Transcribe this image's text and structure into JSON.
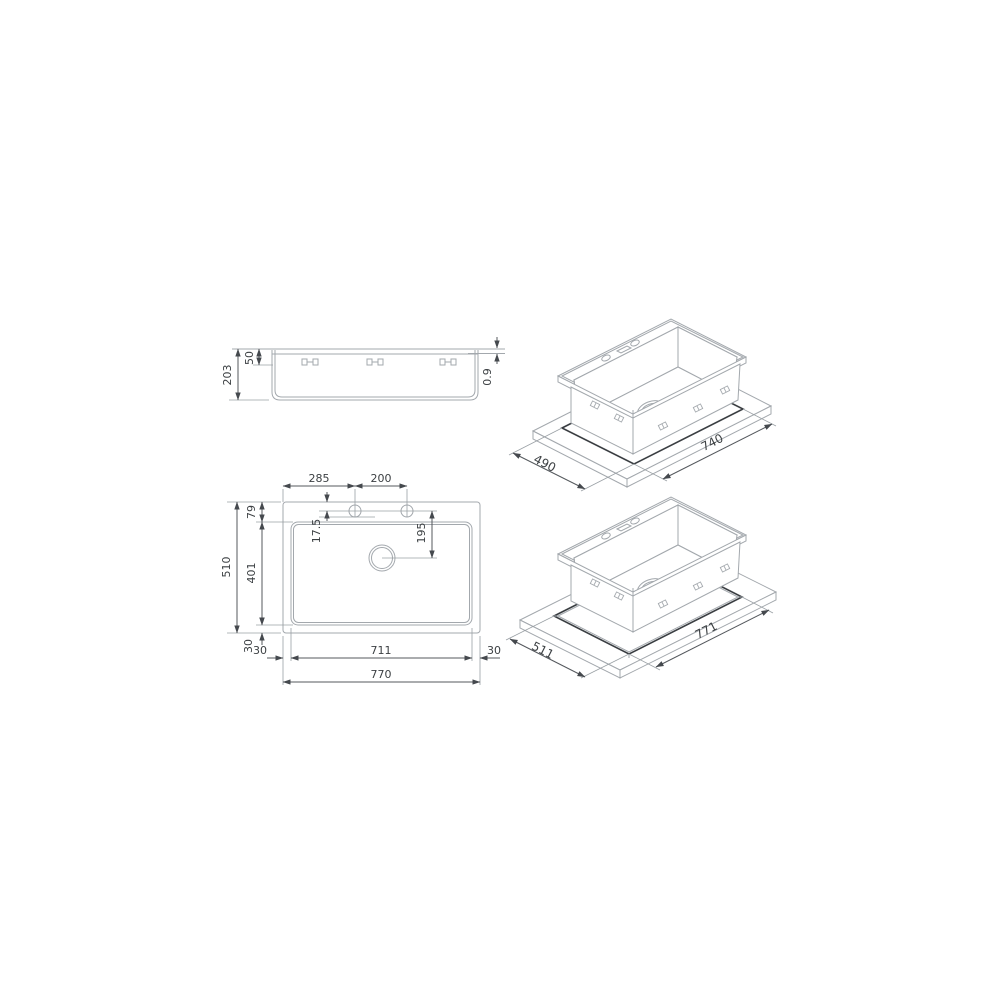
{
  "drawing_title": "Sink technical dimension drawing",
  "colors": {
    "background": "#ffffff",
    "object_line": "#a3a8ad",
    "dimension_line": "#54585d",
    "text": "#3c4043",
    "cutout_line": "#3a3e42"
  },
  "side_view": {
    "overall_height": "203",
    "rim_to_clip": "50",
    "rim_thickness": "0.9"
  },
  "plan_view": {
    "hole_offset_left": "285",
    "hole_spacing": "200",
    "rim_to_bowl_top": "79",
    "overall_depth": "510",
    "bowl_depth": "401",
    "bowl_margin_bottom": "30",
    "bowl_margin_left": "30",
    "bowl_width": "711",
    "bowl_margin_right": "30",
    "overall_width": "770",
    "hole_detail": "17.5",
    "drain_offset": "195"
  },
  "topmount_cutout_view": {
    "cutout_depth": "490",
    "cutout_width": "740"
  },
  "flushmount_cutout_view": {
    "recess_depth": "511",
    "recess_width": "771"
  }
}
